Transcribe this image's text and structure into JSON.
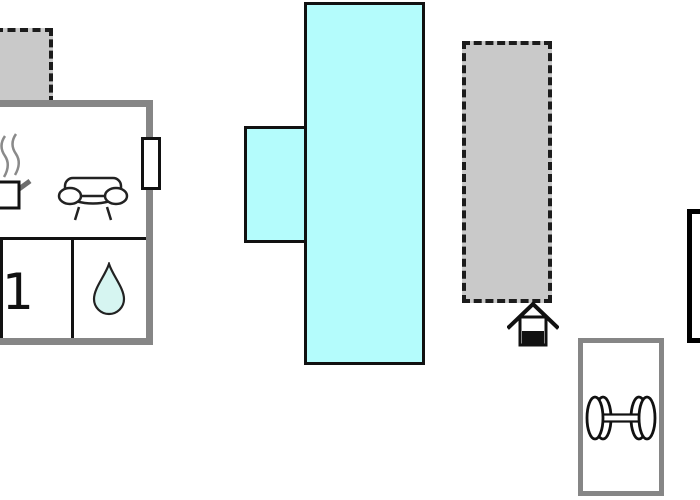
{
  "floor_plan": {
    "rooms": {
      "bedroom_1": {
        "label": "1"
      },
      "bathroom": {
        "icon": "water-drop-icon"
      },
      "kitchen": {
        "icon": "pot-steam-icon"
      },
      "living_room": {
        "icon": "sofa-icon"
      },
      "fitness_room": {
        "icon": "dumbbell-icon"
      }
    },
    "markers": {
      "entrance": {
        "icon": "house-icon"
      },
      "window": {
        "icon": "window-marker"
      }
    },
    "colors": {
      "water_area": "#b4fcfc",
      "water_drop_fill": "#d6f5f1",
      "outbuilding_fill": "#c9c9c9",
      "wall_gray": "#868686",
      "line_black": "#111111",
      "steam_gray": "#8a8a8a"
    }
  }
}
